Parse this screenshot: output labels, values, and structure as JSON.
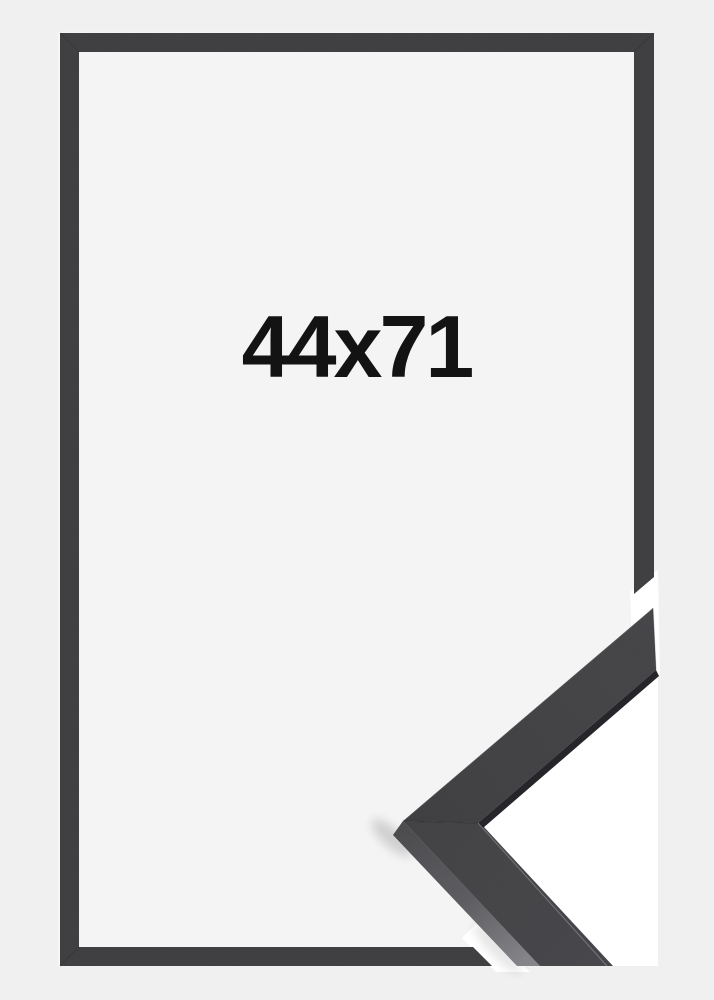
{
  "product": {
    "size_label": "44x71",
    "alt": "Black picture frame, flat front view with corner profile detail overlapping lower right",
    "colors": {
      "background_outer": "#f0f0f1",
      "background_inner": "#f4f4f5",
      "halo_white": "#ffffff",
      "frame_bar": "#39393b",
      "molding_upper_dark": "#39393c",
      "molding_upper_light": "#424245",
      "molding_lower_dark": "#3d3d40",
      "molding_lower_light": "#434347",
      "molding_edge_dark": "#26262a",
      "side_top": "#47474b",
      "side_mid": "#5e5e63",
      "side_bottom": "#8e8e94",
      "label_text": "#131313"
    }
  }
}
